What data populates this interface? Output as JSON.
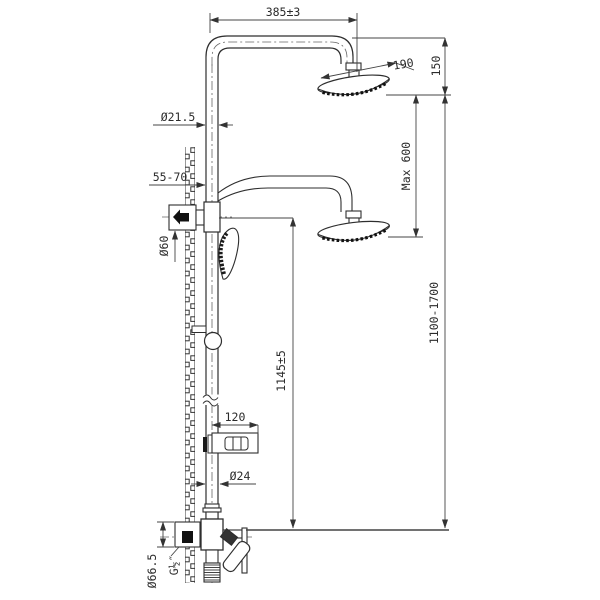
{
  "drawing": {
    "title": "shower-column-technical-drawing",
    "background": "#ffffff",
    "line_color": "#3a3a3a",
    "labels": {
      "width_top": "385±3",
      "head_diameter": "190",
      "top_offset": "150",
      "max_drop": "Max 600",
      "column_height_range": "1100-1700",
      "pipe_diameter_top": "Ø21.5",
      "wall_distance": "55-70",
      "bracket_diameter": "Ø60",
      "handle_height": "1145±5",
      "soap_dish_width": "120",
      "pipe_diameter_bottom": "Ø24",
      "escutcheon_diameter": "Ø66.5",
      "thread_size": "G½″"
    }
  }
}
